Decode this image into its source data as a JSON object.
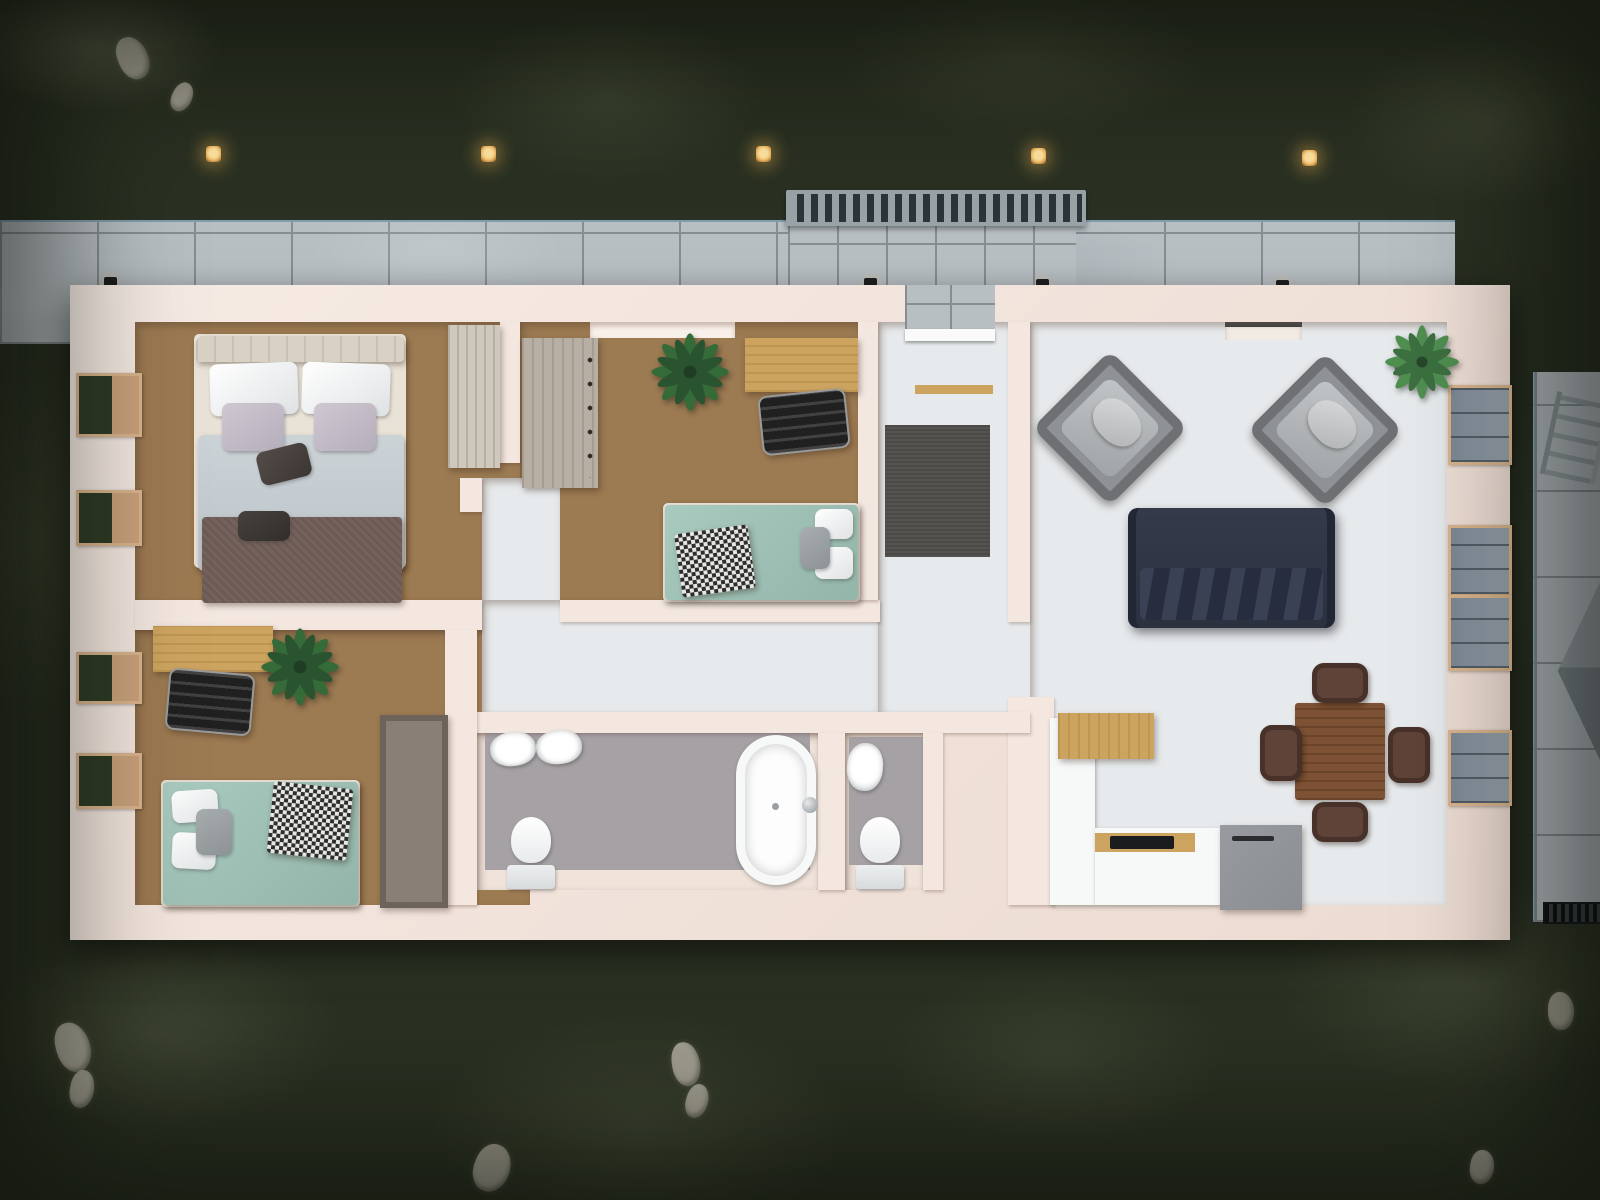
{
  "scene": {
    "description": "Top-down 3D architectural render of a single-storey house floor plan at dusk, surrounded by a lawn",
    "time_of_day": "dusk",
    "exterior": {
      "lawn": "dark green grass with lighter patches and scattered stones",
      "garden_lights_count": 5,
      "exterior_wall_lights_count": 4,
      "walkway_north": "concrete tile path along the top facade",
      "walkway_east": "concrete tile path along the right facade with ladder and grill rack",
      "entry": {
        "patio": "concrete tile entry patio",
        "pergola": "slatted metal pergola over the entrance",
        "front_door": "white door slab",
        "threshold": "oak strip inside the door"
      }
    },
    "rooms": [
      {
        "id": "bedroom-master",
        "floor": "wood parquet",
        "windows": 2,
        "furniture": [
          "double bed with white pillows, lavender cushions, grey duvet, brown throw and two dark accent pillows",
          "light wood wardrobe"
        ]
      },
      {
        "id": "bedroom-2",
        "floor": "wood parquet",
        "windows": 0,
        "furniture": [
          "grey-wood dresser with dark handles",
          "potted plant",
          "oak desk",
          "black office chair",
          "teal single bed with white pillows, grey cushion and houndstooth throw"
        ]
      },
      {
        "id": "corridor",
        "floor": "light ceramic tile",
        "furniture": []
      },
      {
        "id": "entry-hall",
        "floor": "light ceramic tile",
        "furniture": [
          "dark grey rug"
        ]
      },
      {
        "id": "living-dining",
        "floor": "white stone tile",
        "windows": 4,
        "furniture": [
          "grey armchair",
          "grey armchair",
          "navy blue sofa with chevron back cushions",
          "potted plant in grey pot",
          "walnut dining table",
          "four brown dining chairs"
        ]
      },
      {
        "id": "kitchen",
        "floor": "white stone tile",
        "furniture": [
          "white counter",
          "oak breakfast bar",
          "oak worktop with black cooktop",
          "grey island unit with handle"
        ]
      },
      {
        "id": "bathroom",
        "floor": "grey mosaic tile",
        "furniture": [
          "wash basin",
          "wash basin",
          "toilet",
          "freestanding oval bathtub with chrome faucet"
        ]
      },
      {
        "id": "wc",
        "floor": "grey mosaic tile",
        "furniture": [
          "wash basin",
          "toilet"
        ]
      },
      {
        "id": "bedroom-3",
        "floor": "wood parquet",
        "windows": 2,
        "furniture": [
          "oak desk",
          "black office chair",
          "potted plant",
          "teal single bed with white pillows, grey cushion and houndstooth throw",
          "grey wardrobe"
        ]
      }
    ]
  },
  "palette": {
    "grass": "#2a3122",
    "grassLight": "#596147",
    "stone": "#b5b1a3",
    "concrete": "#b8bfc3",
    "concreteLine": "#878e92",
    "wall": "#f3e7e0",
    "wallShade": "#e2d1c7",
    "creamFloor": "#efe3da",
    "wood": "#9c7a52",
    "woodDark": "#7b5c3c",
    "tile": "#e7eaec",
    "tileMid": "#d3d8db",
    "mosaic": "#a5a1a4",
    "teal": "#a9cabf",
    "navy": "#2c3140",
    "armchairGray": "#8f9295",
    "oak": "#cda45f",
    "walnut": "#7d5133",
    "chairBrown": "#5f4238",
    "white": "#f7f8f8",
    "rug": "#4b4a47",
    "duvet": "#ccd3d7",
    "blanket": "#6d5a54",
    "glassDark": "#2e3b26",
    "glassBlue": "#7c8894",
    "frame": "#d9b48c",
    "lightGlow": "#f5c06a",
    "metal": "#98a2a7",
    "counterGray": "#8b8f93"
  }
}
